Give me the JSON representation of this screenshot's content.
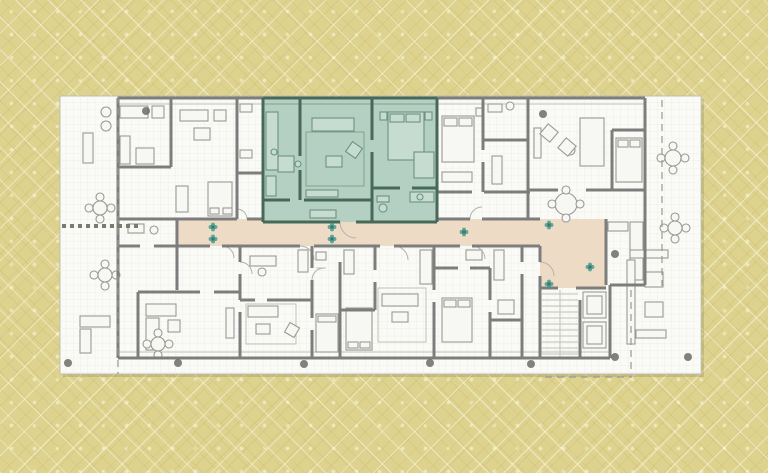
{
  "canvas": {
    "w": 768,
    "h": 473
  },
  "colors": {
    "bg": "#ddd28e",
    "sheet": "#fafaf7",
    "sheet_border": "#bdbdb2",
    "sheet_shadow": "rgba(90,82,40,0.18)",
    "grid": "#ececе6",
    "grid_line": "#ededE8",
    "wall": "#7d7d7d",
    "thin": "#c2c2bb",
    "furn_stroke": "#9a9a94",
    "furn_fill": "#f7f7f4",
    "arc": "#b3b3ad",
    "dash": "#9a9a90",
    "corridor": "#eddbc6",
    "green_fill": "#b4d0c2",
    "green_wall": "#48685a",
    "green_furn": "#6c9280",
    "green_thin": "#7fa390",
    "green_furn_fill": "#c6dcd0",
    "plant": "#3e968b",
    "dot": "#6c6c66",
    "pergola": "#7a7a70"
  },
  "sheet": {
    "x": 60,
    "y": 96,
    "w": 641,
    "h": 278
  },
  "corridor": {
    "band": [
      177,
      219,
      363,
      27
    ],
    "lobby": [
      540,
      219,
      66,
      69
    ]
  },
  "green_unit": {
    "rect": [
      263,
      98,
      174,
      124
    ],
    "walls": [
      [
        263,
        98,
        437,
        98
      ],
      [
        437,
        98,
        437,
        222
      ],
      [
        263,
        222,
        340,
        222
      ],
      [
        356,
        222,
        437,
        222
      ],
      [
        263,
        98,
        263,
        222
      ],
      [
        300,
        98,
        300,
        156
      ],
      [
        300,
        170,
        300,
        200
      ],
      [
        263,
        200,
        290,
        200
      ],
      [
        304,
        200,
        372,
        200
      ],
      [
        372,
        98,
        372,
        140
      ],
      [
        372,
        152,
        372,
        222
      ],
      [
        372,
        188,
        400,
        188
      ],
      [
        412,
        188,
        437,
        188
      ]
    ],
    "thin": [
      [
        263,
        104,
        437,
        104
      ],
      [
        266,
        122,
        278,
        122
      ],
      [
        266,
        132,
        278,
        132
      ],
      [
        266,
        142,
        278,
        142
      ],
      [
        266,
        152,
        278,
        152
      ],
      [
        266,
        162,
        278,
        162
      ]
    ],
    "rects": [
      [
        266,
        112,
        12,
        58
      ],
      [
        278,
        156,
        16,
        16
      ],
      [
        266,
        176,
        10,
        20
      ],
      [
        312,
        118,
        42,
        13
      ],
      [
        326,
        156,
        16,
        11
      ],
      [
        306,
        190,
        32,
        7
      ],
      [
        388,
        112,
        36,
        48
      ],
      [
        390,
        114,
        14,
        8
      ],
      [
        406,
        114,
        14,
        8
      ],
      [
        380,
        112,
        7,
        8
      ],
      [
        425,
        112,
        7,
        8
      ],
      [
        414,
        152,
        20,
        26
      ],
      [
        410,
        192,
        24,
        10
      ],
      [
        377,
        196,
        12,
        6
      ],
      [
        310,
        210,
        26,
        8
      ]
    ],
    "circles": [
      [
        274,
        152,
        3
      ],
      [
        298,
        164,
        3
      ],
      [
        420,
        197,
        3
      ],
      [
        383,
        208,
        4
      ]
    ],
    "rot": [
      [
        354,
        150,
        12,
        35
      ]
    ],
    "rug": [
      306,
      132,
      58,
      54
    ]
  },
  "walls": [
    [
      118,
      98,
      263,
      98
    ],
    [
      437,
      98,
      645,
      98
    ],
    [
      645,
      98,
      645,
      285
    ],
    [
      610,
      285,
      645,
      285
    ],
    [
      610,
      285,
      610,
      358
    ],
    [
      118,
      358,
      610,
      358
    ],
    [
      118,
      98,
      118,
      358
    ],
    [
      171,
      98,
      171,
      167
    ],
    [
      118,
      167,
      171,
      167
    ],
    [
      237,
      98,
      237,
      219
    ],
    [
      237,
      173,
      263,
      173
    ],
    [
      483,
      98,
      483,
      150
    ],
    [
      483,
      162,
      483,
      192
    ],
    [
      437,
      192,
      472,
      192
    ],
    [
      484,
      192,
      530,
      192
    ],
    [
      483,
      140,
      528,
      140
    ],
    [
      528,
      98,
      528,
      219
    ],
    [
      528,
      190,
      558,
      190
    ],
    [
      586,
      190,
      645,
      190
    ],
    [
      606,
      219,
      606,
      285
    ],
    [
      612,
      130,
      612,
      190
    ],
    [
      612,
      130,
      645,
      130
    ],
    [
      177,
      219,
      237,
      219
    ],
    [
      247,
      219,
      263,
      219
    ],
    [
      437,
      219,
      470,
      219
    ],
    [
      482,
      219,
      540,
      219
    ],
    [
      177,
      246,
      210,
      246
    ],
    [
      222,
      246,
      300,
      246
    ],
    [
      314,
      246,
      380,
      246
    ],
    [
      394,
      246,
      460,
      246
    ],
    [
      472,
      246,
      540,
      246
    ],
    [
      177,
      219,
      177,
      246
    ],
    [
      118,
      219,
      177,
      219
    ],
    [
      118,
      246,
      140,
      246
    ],
    [
      154,
      246,
      177,
      246
    ],
    [
      540,
      246,
      540,
      262
    ],
    [
      540,
      276,
      540,
      288
    ],
    [
      540,
      288,
      558,
      288
    ],
    [
      576,
      288,
      606,
      288
    ],
    [
      540,
      288,
      540,
      358
    ],
    [
      580,
      300,
      580,
      358
    ],
    [
      240,
      246,
      240,
      262
    ],
    [
      240,
      274,
      240,
      300
    ],
    [
      240,
      312,
      240,
      358
    ],
    [
      177,
      246,
      177,
      290
    ],
    [
      138,
      292,
      200,
      292
    ],
    [
      214,
      292,
      240,
      292
    ],
    [
      138,
      292,
      138,
      358
    ],
    [
      312,
      246,
      312,
      268
    ],
    [
      312,
      280,
      312,
      318
    ],
    [
      312,
      330,
      312,
      358
    ],
    [
      240,
      300,
      255,
      300
    ],
    [
      267,
      300,
      312,
      300
    ],
    [
      340,
      262,
      340,
      358
    ],
    [
      375,
      246,
      375,
      270
    ],
    [
      375,
      282,
      375,
      310
    ],
    [
      340,
      310,
      375,
      310
    ],
    [
      434,
      246,
      434,
      290
    ],
    [
      434,
      302,
      434,
      358
    ],
    [
      434,
      268,
      458,
      268
    ],
    [
      470,
      268,
      490,
      268
    ],
    [
      490,
      268,
      490,
      300
    ],
    [
      490,
      312,
      490,
      358
    ],
    [
      490,
      320,
      522,
      320
    ],
    [
      522,
      246,
      522,
      262
    ],
    [
      522,
      274,
      522,
      358
    ]
  ],
  "thin": [
    [
      118,
      104,
      263,
      104
    ],
    [
      437,
      104,
      645,
      104
    ],
    [
      118,
      352,
      610,
      352
    ],
    [
      630,
      232,
      643,
      232
    ],
    [
      630,
      242,
      643,
      242
    ],
    [
      630,
      252,
      643,
      252
    ],
    [
      630,
      262,
      643,
      262
    ],
    [
      630,
      272,
      643,
      272
    ],
    [
      420,
      260,
      432,
      260
    ],
    [
      420,
      268,
      432,
      268
    ],
    [
      420,
      276,
      432,
      276
    ],
    [
      494,
      258,
      504,
      258
    ],
    [
      494,
      266,
      504,
      266
    ],
    [
      494,
      274,
      504,
      274
    ],
    [
      316,
      260,
      326,
      260
    ],
    [
      316,
      268,
      326,
      268
    ],
    [
      542,
      294,
      578,
      294
    ],
    [
      542,
      300,
      578,
      300
    ],
    [
      542,
      306,
      578,
      306
    ],
    [
      542,
      312,
      578,
      312
    ],
    [
      542,
      318,
      578,
      318
    ],
    [
      542,
      324,
      578,
      324
    ],
    [
      542,
      330,
      578,
      330
    ],
    [
      542,
      336,
      578,
      336
    ],
    [
      542,
      342,
      578,
      342
    ],
    [
      542,
      348,
      578,
      348
    ],
    [
      542,
      354,
      578,
      354
    ],
    [
      560,
      290,
      560,
      358
    ]
  ],
  "furniture": {
    "rects": [
      [
        120,
        106,
        28,
        12
      ],
      [
        152,
        106,
        12,
        12
      ],
      [
        120,
        136,
        10,
        28
      ],
      [
        136,
        148,
        18,
        16
      ],
      [
        83,
        133,
        10,
        30
      ],
      [
        180,
        110,
        28,
        11
      ],
      [
        214,
        110,
        12,
        11
      ],
      [
        194,
        128,
        16,
        12
      ],
      [
        176,
        186,
        12,
        26
      ],
      [
        208,
        182,
        24,
        34
      ],
      [
        210,
        208,
        9,
        6
      ],
      [
        223,
        208,
        9,
        6
      ],
      [
        128,
        224,
        16,
        9
      ],
      [
        240,
        104,
        12,
        8
      ],
      [
        240,
        150,
        12,
        8
      ],
      [
        442,
        116,
        32,
        46
      ],
      [
        444,
        118,
        13,
        8
      ],
      [
        459,
        118,
        13,
        8
      ],
      [
        476,
        108,
        7,
        8
      ],
      [
        442,
        172,
        30,
        10
      ],
      [
        488,
        104,
        14,
        8
      ],
      [
        492,
        156,
        10,
        28
      ],
      [
        580,
        118,
        24,
        48
      ],
      [
        534,
        128,
        7,
        30
      ],
      [
        630,
        222,
        13,
        58
      ],
      [
        608,
        222,
        20,
        9
      ],
      [
        616,
        138,
        26,
        44
      ],
      [
        618,
        140,
        10,
        7
      ],
      [
        630,
        140,
        10,
        7
      ],
      [
        250,
        256,
        26,
        10
      ],
      [
        298,
        250,
        10,
        22
      ],
      [
        248,
        306,
        30,
        11
      ],
      [
        256,
        324,
        14,
        10
      ],
      [
        316,
        252,
        10,
        8
      ],
      [
        316,
        314,
        22,
        38
      ],
      [
        318,
        316,
        18,
        6
      ],
      [
        344,
        250,
        10,
        24
      ],
      [
        346,
        308,
        26,
        42
      ],
      [
        348,
        342,
        10,
        6
      ],
      [
        360,
        342,
        10,
        6
      ],
      [
        382,
        294,
        36,
        12
      ],
      [
        392,
        312,
        16,
        10
      ],
      [
        420,
        250,
        12,
        34
      ],
      [
        442,
        298,
        30,
        44
      ],
      [
        444,
        300,
        12,
        7
      ],
      [
        458,
        300,
        12,
        7
      ],
      [
        466,
        250,
        16,
        10
      ],
      [
        494,
        250,
        10,
        30
      ],
      [
        498,
        300,
        16,
        14
      ],
      [
        583,
        292,
        23,
        26
      ],
      [
        587,
        296,
        15,
        18
      ],
      [
        583,
        322,
        23,
        26
      ],
      [
        587,
        326,
        15,
        18
      ],
      [
        630,
        250,
        38,
        8
      ],
      [
        627,
        260,
        8,
        84
      ],
      [
        645,
        272,
        18,
        15
      ],
      [
        645,
        302,
        18,
        15
      ],
      [
        636,
        330,
        30,
        8
      ],
      [
        80,
        316,
        30,
        11
      ],
      [
        80,
        329,
        11,
        24
      ],
      [
        146,
        304,
        30,
        12
      ],
      [
        146,
        318,
        13,
        32
      ],
      [
        168,
        320,
        12,
        12
      ],
      [
        226,
        308,
        8,
        30
      ]
    ],
    "circles": [
      [
        154,
        230,
        4
      ],
      [
        106,
        112,
        5
      ],
      [
        106,
        126,
        5
      ],
      [
        510,
        106,
        4
      ],
      [
        570,
        150,
        5
      ],
      [
        262,
        272,
        4
      ],
      [
        566,
        204,
        11
      ],
      [
        566,
        190,
        4
      ],
      [
        566,
        218,
        4
      ],
      [
        552,
        204,
        4
      ],
      [
        580,
        204,
        4
      ],
      [
        100,
        208,
        7
      ],
      [
        100,
        197,
        4
      ],
      [
        100,
        219,
        4
      ],
      [
        89,
        208,
        4
      ],
      [
        111,
        208,
        4
      ],
      [
        105,
        275,
        7
      ],
      [
        105,
        264,
        4
      ],
      [
        105,
        286,
        4
      ],
      [
        94,
        275,
        4
      ],
      [
        116,
        275,
        4
      ],
      [
        158,
        344,
        7
      ],
      [
        158,
        333,
        4
      ],
      [
        158,
        355,
        4
      ],
      [
        147,
        344,
        4
      ],
      [
        169,
        344,
        4
      ],
      [
        673,
        158,
        8
      ],
      [
        673,
        146,
        4
      ],
      [
        673,
        170,
        4
      ],
      [
        661,
        158,
        4
      ],
      [
        685,
        158,
        4
      ],
      [
        675,
        228,
        7
      ],
      [
        675,
        217,
        4
      ],
      [
        675,
        239,
        4
      ],
      [
        664,
        228,
        4
      ],
      [
        686,
        228,
        4
      ]
    ],
    "rot": [
      [
        549,
        133,
        13,
        40
      ],
      [
        567,
        147,
        13,
        40
      ],
      [
        292,
        330,
        11,
        30
      ]
    ],
    "rugs": [
      [
        246,
        304,
        50,
        40
      ],
      [
        378,
        288,
        48,
        54
      ]
    ]
  },
  "arcs": [
    "M300,246 a14,14 0 0 1 14,14",
    "M394,246 a14,14 0 0 1 14,14",
    "M472,246 a13,13 0 0 1 13,13",
    "M222,246 a12,12 0 0 1 12,12",
    "M247,219 a10,10 0 0 0 -10,-10",
    "M470,219 a12,12 0 0 1 12,-12",
    "M340,222 a16,16 0 0 0 16,16",
    "M540,262 a14,14 0 0 1 14,14",
    "M240,262 a12,12 0 0 1 12,12",
    "M312,280 a12,12 0 0 1 12,-12"
  ],
  "plants": [
    [
      213,
      227
    ],
    [
      213,
      239
    ],
    [
      332,
      227
    ],
    [
      332,
      239
    ],
    [
      464,
      232
    ],
    [
      549,
      225
    ],
    [
      549,
      284
    ],
    [
      590,
      267
    ]
  ],
  "dots": [
    [
      68,
      363,
      4
    ],
    [
      178,
      363,
      4
    ],
    [
      304,
      364,
      4
    ],
    [
      430,
      363,
      4
    ],
    [
      531,
      364,
      4
    ],
    [
      615,
      254,
      4
    ],
    [
      615,
      357,
      4
    ],
    [
      688,
      357,
      4
    ],
    [
      146,
      111,
      4
    ],
    [
      543,
      114,
      4
    ]
  ],
  "pergola": {
    "xs": [
      62,
      70,
      78,
      86,
      94,
      102,
      110,
      118,
      126,
      134
    ],
    "y": 224,
    "size": 4
  },
  "dashes": [
    [
      118,
      96,
      118,
      374
    ],
    [
      662,
      100,
      662,
      286
    ],
    [
      631,
      290,
      631,
      372
    ],
    [
      545,
      377,
      632,
      377
    ]
  ]
}
